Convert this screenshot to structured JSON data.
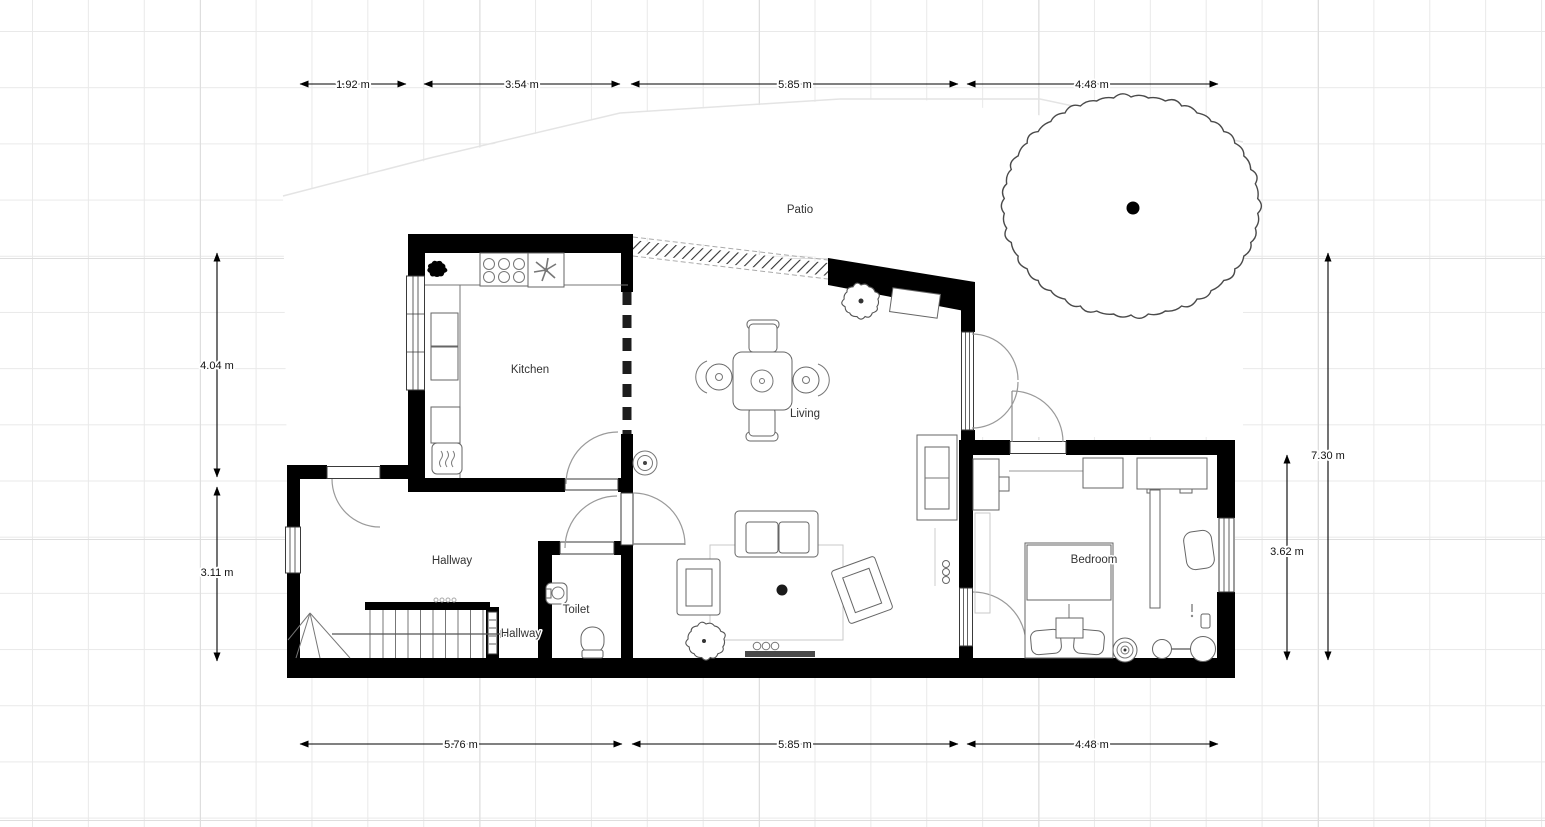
{
  "rooms": {
    "kitchen": "Kitchen",
    "living": "Living",
    "patio": "Patio",
    "hallway": "Hallway",
    "hallway_lower": "Hallway",
    "toilet": "Toilet",
    "bedroom": "Bedroom"
  },
  "dimensions": {
    "top": [
      "1.92 m",
      "3.54 m",
      "5.85 m",
      "4.48 m"
    ],
    "bottom": [
      "5.76 m",
      "5.85 m",
      "4.48 m"
    ],
    "left": [
      "4.04 m",
      "3.11 m"
    ],
    "right": [
      "7.30 m",
      "3.62 m"
    ]
  },
  "icons": {
    "tree": "scalloped-circle",
    "plant": "scalloped-circle-with-dot",
    "kitchen_plant": "black-blob",
    "stove": "six-burner-circles",
    "extractor_fan": "fan-asterisk",
    "oven": "heat-wave-box",
    "ceiling_light": "concentric-circles",
    "speaker_light": "concentric-circles",
    "floor_lamp": "two-circles-with-line",
    "stairs_direction": "arrow-right"
  },
  "colors": {
    "wall": "#000000",
    "background": "#ffffff",
    "grid_minor": "#e9e9e9",
    "grid_major": "#dedede",
    "furniture_stroke": "#666666",
    "door_arc": "#9a9a9a",
    "dimension_text": "#111111",
    "label_text": "#333333"
  }
}
